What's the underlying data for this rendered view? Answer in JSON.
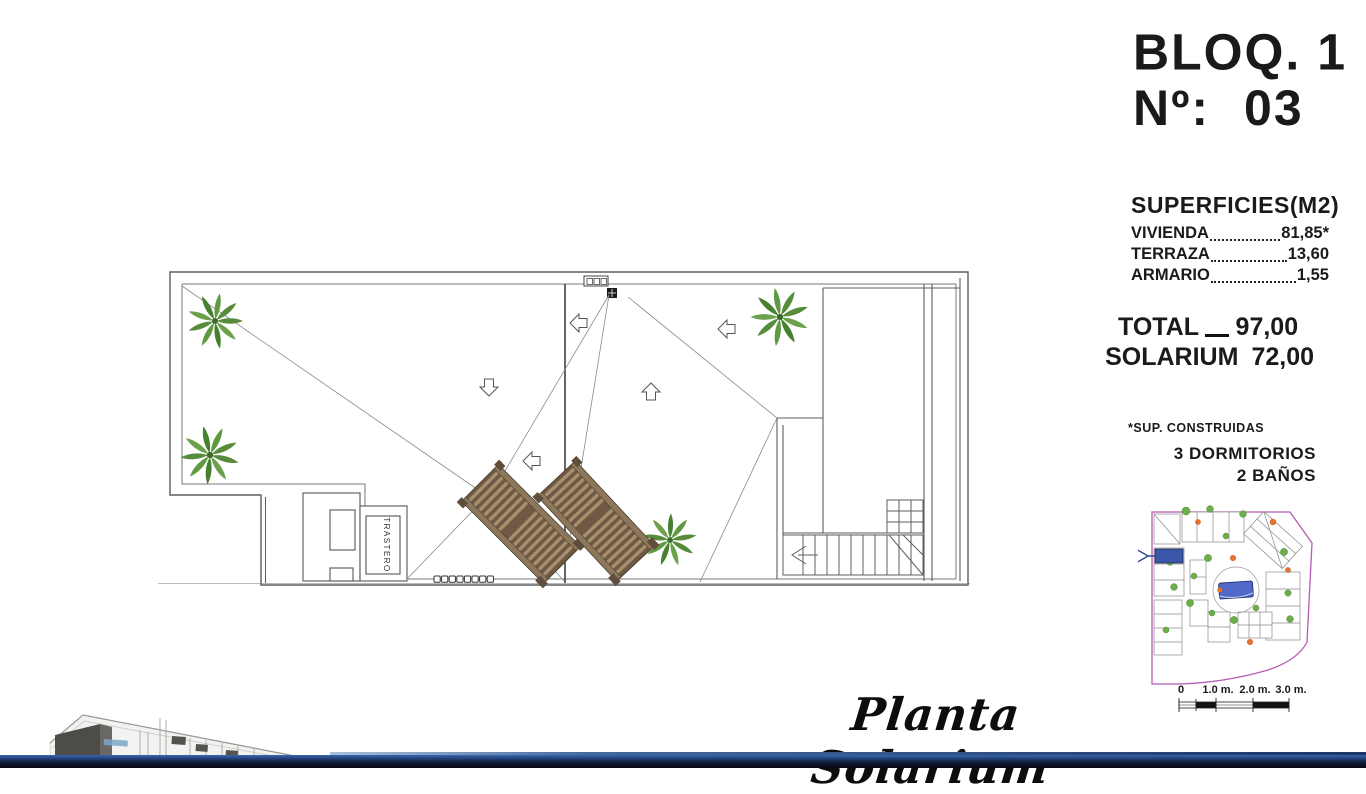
{
  "header": {
    "block_label": "BLOQ. 1",
    "number_label": "Nº:",
    "number_value": "03"
  },
  "surfaces": {
    "title": "SUPERFICIES(M2)",
    "rows": [
      {
        "label": "VIVIENDA",
        "value": "81,85*"
      },
      {
        "label": "TERRAZA",
        "value": "13,60"
      },
      {
        "label": "ARMARIO",
        "value": "1,55"
      }
    ],
    "totals": [
      {
        "label": "TOTAL",
        "value": "97,00"
      },
      {
        "label": "SOLARIUM",
        "value": "72,00"
      }
    ],
    "footnote": "*SUP. CONSTRUIDAS",
    "features": [
      "3 DORMITORIOS",
      "2 BAÑOS"
    ]
  },
  "plan": {
    "title": "Planta Solarium",
    "storage_label": "TRASTERO"
  },
  "scale_bar": {
    "labels": [
      "0",
      "1.0 m.",
      "2.0 m.",
      "3.0 m."
    ]
  },
  "colors": {
    "line": "#666666",
    "palm_green": "#5a9140",
    "lounger_brown": "#8a7358",
    "minimap_boundary": "#b55ab5",
    "pool_blue": "#5068c8",
    "unit_highlight": "#3a57a8",
    "footer_navy": "#101d3a"
  }
}
